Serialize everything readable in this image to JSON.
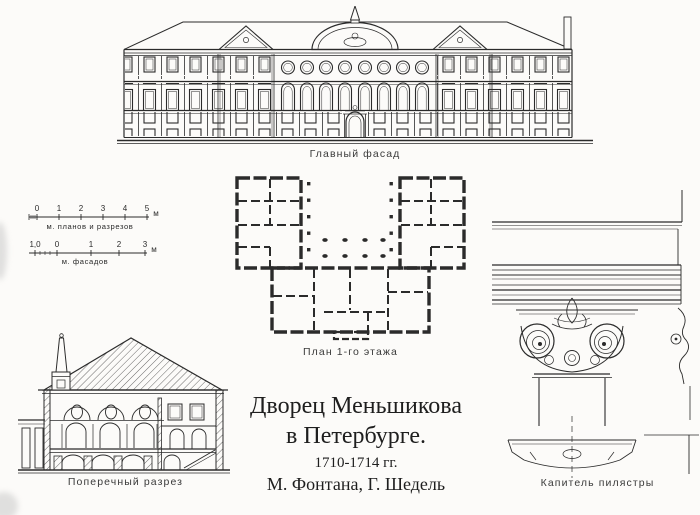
{
  "colors": {
    "ink": "#2b2b2b",
    "paper": "#fcfbf9"
  },
  "drawings": {
    "facade": {
      "label": "Главный фасад"
    },
    "plan": {
      "label": "План 1-го этажа"
    },
    "section": {
      "label": "Поперечный разрез"
    },
    "capital": {
      "label": "Капитель пилястры"
    }
  },
  "scales": {
    "plans_sections": {
      "numbers": [
        "0",
        "1",
        "2",
        "3",
        "4",
        "5"
      ],
      "unit": "м",
      "label": "м. планов и разрезов"
    },
    "facades": {
      "numbers": [
        "1,0",
        "0",
        "1",
        "2",
        "3"
      ],
      "unit": "м",
      "label": "м. фасадов"
    }
  },
  "title": {
    "line1": "Дворец Меньшикова",
    "line2": "в Петербурге.",
    "line3": "1710-1714 гг.",
    "line4": "М. Фонтана, Г. Шедель"
  }
}
